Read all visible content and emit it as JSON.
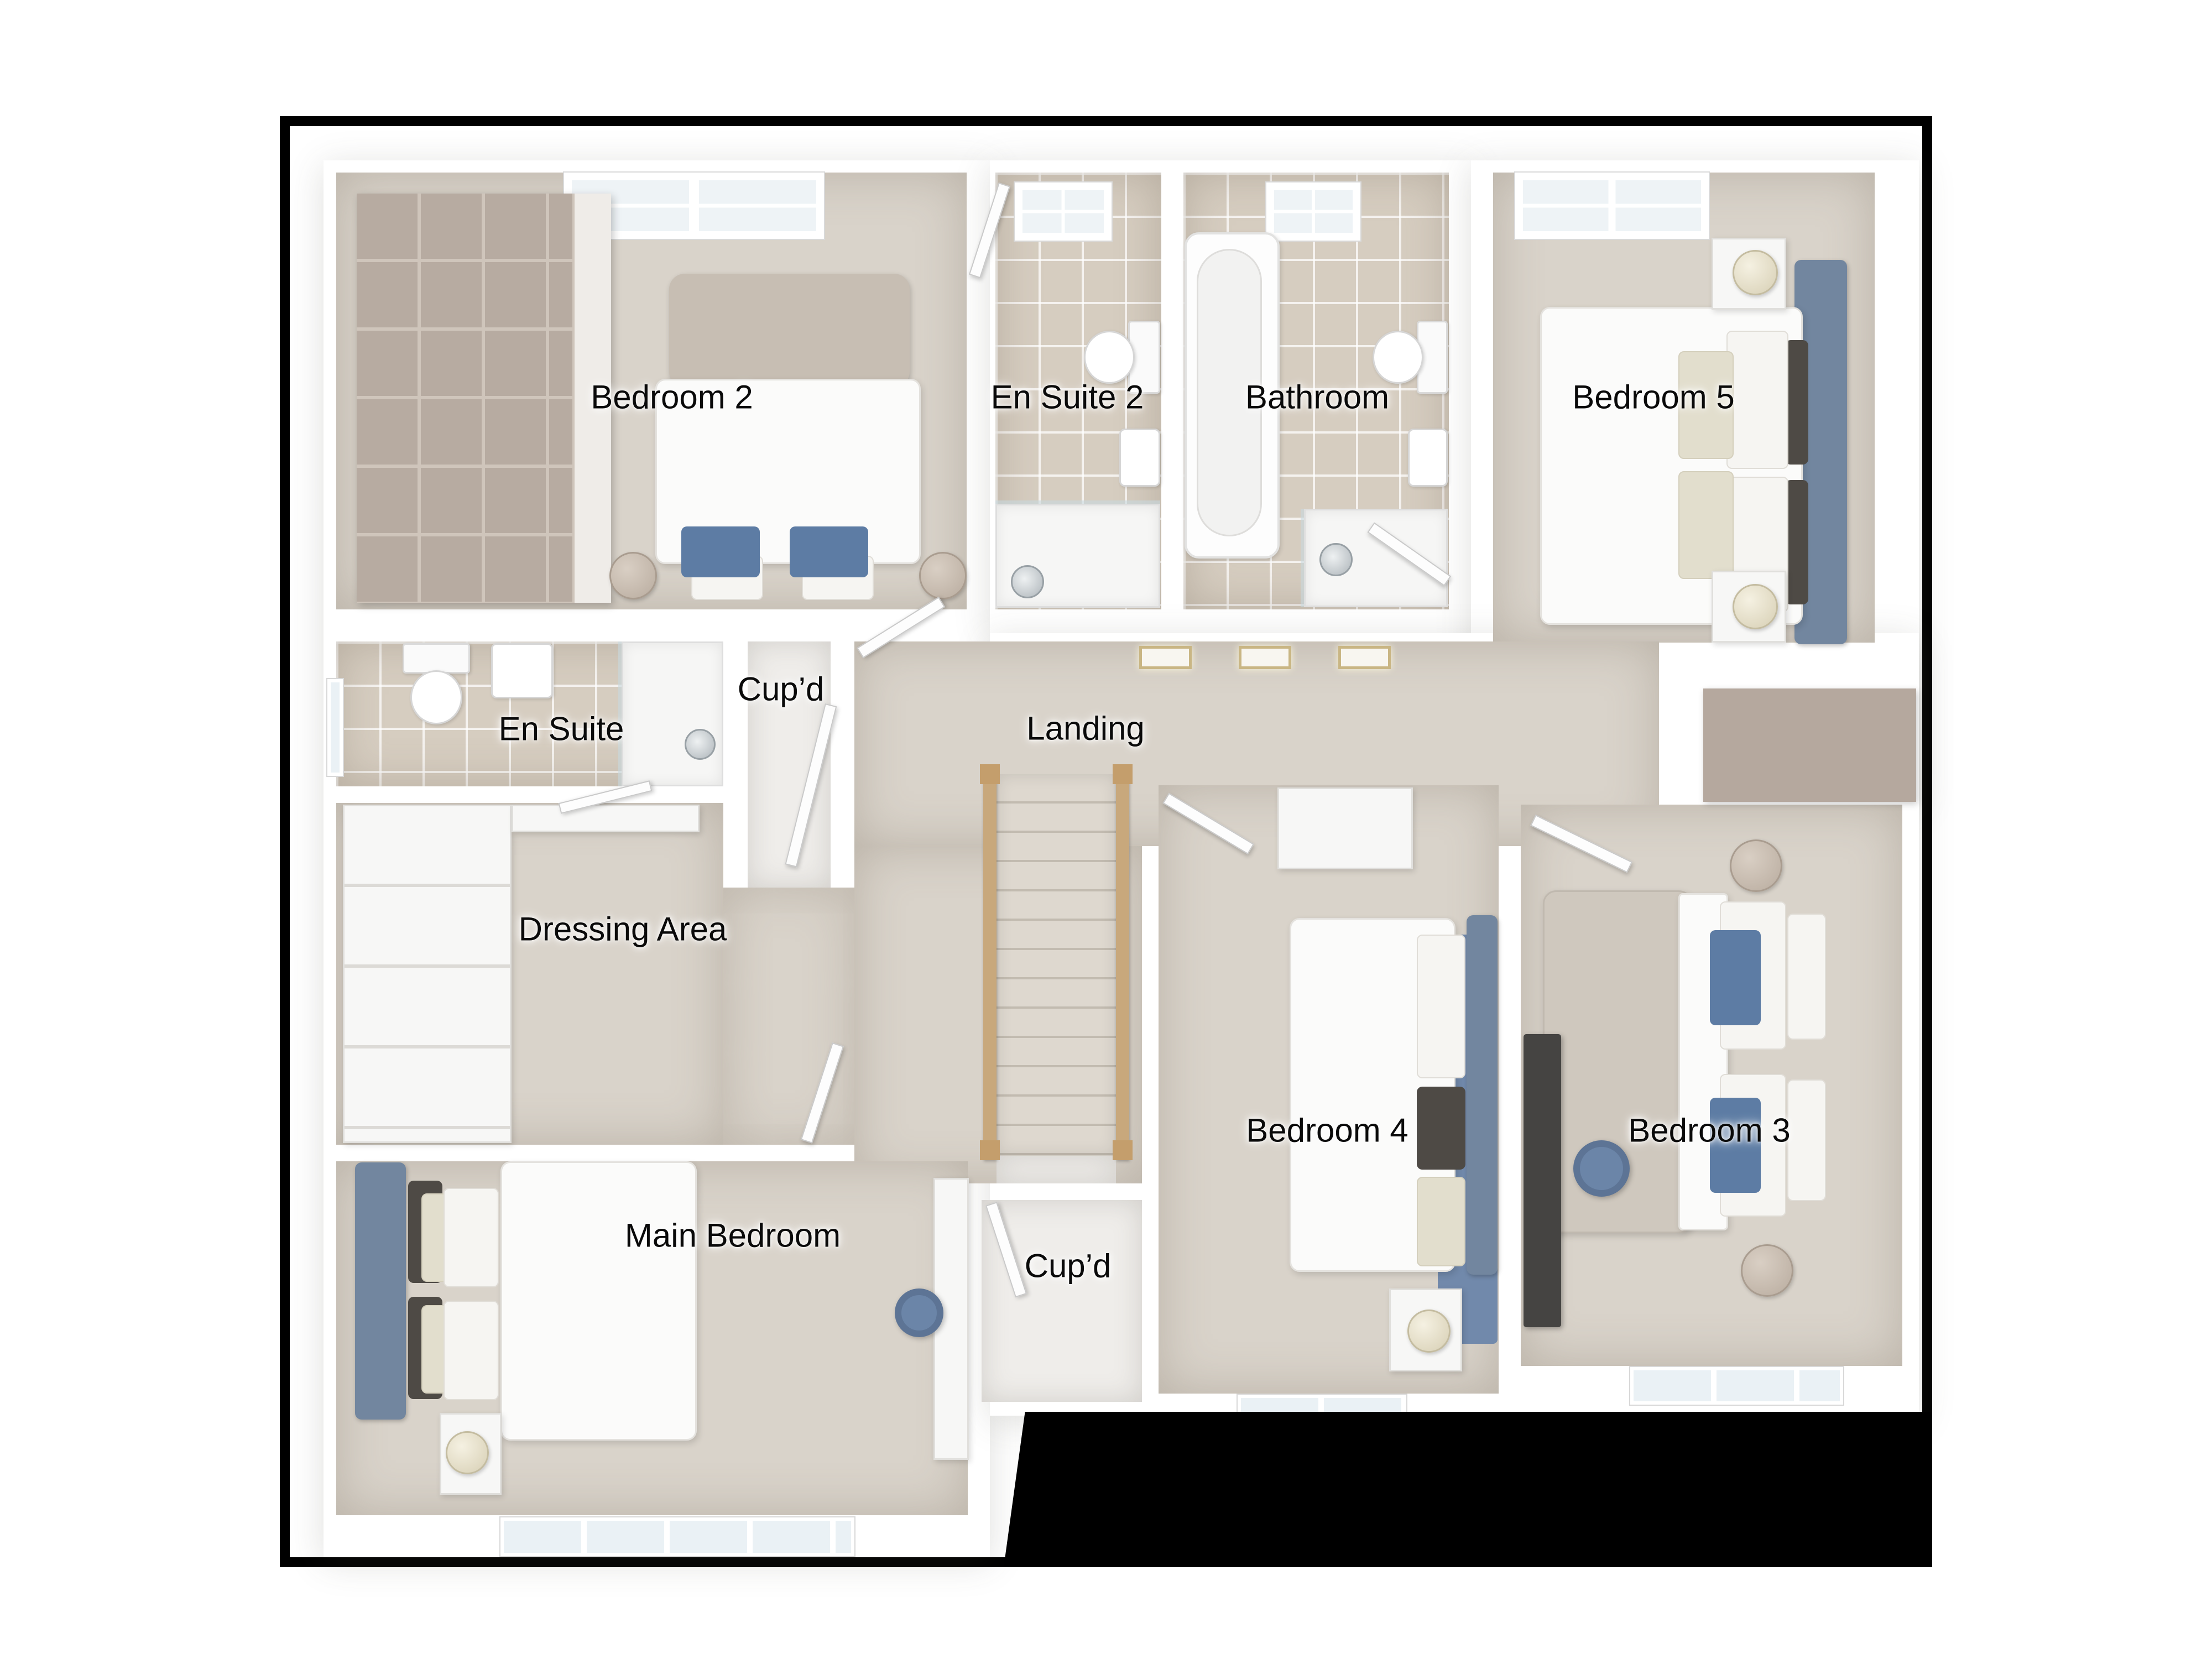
{
  "floorplan": {
    "type": "residential-first-floor-plan",
    "rooms": [
      {
        "id": "bedroom-2",
        "label": "Bedroom 2"
      },
      {
        "id": "en-suite-2",
        "label": "En Suite 2"
      },
      {
        "id": "bathroom",
        "label": "Bathroom"
      },
      {
        "id": "bedroom-5",
        "label": "Bedroom 5"
      },
      {
        "id": "en-suite",
        "label": "En Suite"
      },
      {
        "id": "cupboard-top",
        "label": "Cup’d"
      },
      {
        "id": "landing",
        "label": "Landing"
      },
      {
        "id": "dressing-area",
        "label": "Dressing Area"
      },
      {
        "id": "main-bedroom",
        "label": "Main Bedroom"
      },
      {
        "id": "cupboard-bottom",
        "label": "Cup’d"
      },
      {
        "id": "bedroom-4",
        "label": "Bedroom 4"
      },
      {
        "id": "bedroom-3",
        "label": "Bedroom 3"
      }
    ],
    "colors": {
      "frame": "#000000",
      "wall": "#ffffff",
      "carpet": "#d9d3ca",
      "tile": "#d6cdc0",
      "accent_blue_headboard": "#72869f",
      "pillow_blue": "#5d7ca4",
      "stair_wood": "#c8a87c",
      "taupe_furniture": "#b5a89e",
      "label_text": "#0a0a0a"
    }
  }
}
